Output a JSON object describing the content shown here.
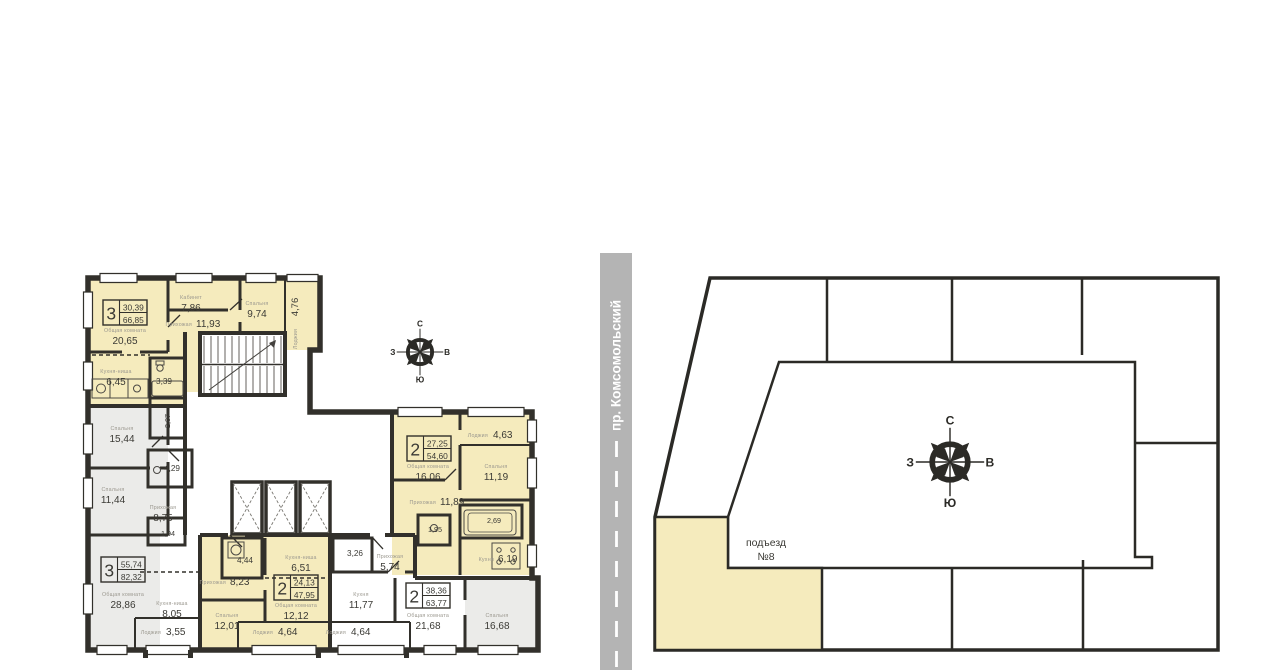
{
  "street": {
    "name": "пр. Комсомольский"
  },
  "site": {
    "entrance_line1": "подъезд",
    "entrance_line2": "№8"
  },
  "compass": {
    "n": "С",
    "s": "Ю",
    "w": "З",
    "e": "В"
  },
  "colors": {
    "highlight": "#f5ebbd",
    "wall": "#32302b",
    "room_gray": "#ebebe9",
    "road": "#b4b4b4"
  },
  "badges": {
    "a3_top": {
      "num": "3",
      "living": "30,39",
      "total": "66,85"
    },
    "a3_left": {
      "num": "3",
      "living": "55,74",
      "total": "82,32"
    },
    "a2_mid": {
      "num": "2",
      "living": "24,13",
      "total": "47,95"
    },
    "a2_bottom": {
      "num": "2",
      "living": "38,36",
      "total": "63,77"
    },
    "a2_right": {
      "num": "2",
      "living": "27,25",
      "total": "54,60"
    }
  },
  "rooms": {
    "r_obsh_top": {
      "name": "Общая комната",
      "area": "20,65"
    },
    "r_kabinet": {
      "name": "Кабинет",
      "area": "7,86"
    },
    "r_prihoz_top": {
      "name": "Прихожая",
      "area": "11,93"
    },
    "r_spalnya_974": {
      "name": "Спальня",
      "area": "9,74"
    },
    "r_lodzhiya_476": {
      "name": "Лоджия",
      "area": "4,76"
    },
    "r_kuhnya_645": {
      "name": "Кухня-ниша",
      "area": "6,45"
    },
    "r_san_339": {
      "area": "3,39"
    },
    "r_san_207": {
      "area": "2,07"
    },
    "r_spalnya_1544": {
      "name": "Спальня",
      "area": "15,44"
    },
    "r_spalnya_1144": {
      "name": "Спальня",
      "area": "11,44"
    },
    "r_san_429": {
      "area": "4,29"
    },
    "r_prihoz_875": {
      "name": "Прихожая",
      "area": "8,75"
    },
    "r_san_194": {
      "area": "1,94"
    },
    "r_obsh_2886": {
      "name": "Общая комната",
      "area": "28,86"
    },
    "r_kuhnya_805": {
      "name": "Кухня-ниша",
      "area": "8,05"
    },
    "r_lodzhiya_355": {
      "name": "Лоджия",
      "area": "3,55"
    },
    "r_san_444": {
      "area": "4,44"
    },
    "r_prihoz_823": {
      "name": "Прихожая",
      "area": "8,23"
    },
    "r_spalnya_1201": {
      "name": "Спальня",
      "area": "12,01"
    },
    "r_kuhnya_651": {
      "name": "Кухня-ниша",
      "area": "6,51"
    },
    "r_obsh_1212": {
      "name": "Общая комната",
      "area": "12,12"
    },
    "r_lodzhiya_464a": {
      "name": "Лоджия",
      "area": "4,64"
    },
    "r_san_326": {
      "area": "3,26"
    },
    "r_prihoz_574": {
      "name": "Прихожая",
      "area": "5,74"
    },
    "r_kuhnya_1177": {
      "name": "Кухня",
      "area": "11,77"
    },
    "r_lodzhiya_464b": {
      "name": "Лоджия",
      "area": "4,64"
    },
    "r_obsh_2168": {
      "name": "Общая комната",
      "area": "21,68"
    },
    "r_spalnya_1668": {
      "name": "Спальня",
      "area": "16,68"
    },
    "r_obsh_1606": {
      "name": "Общая комната",
      "area": "16,06"
    },
    "r_lodzhiya_463": {
      "name": "Лоджия",
      "area": "4,63"
    },
    "r_spalnya_1119": {
      "name": "Спальня",
      "area": "11,19"
    },
    "r_prihoz_1189": {
      "name": "Прихожая",
      "area": "11,89"
    },
    "r_san_195": {
      "area": "1,95"
    },
    "r_san_269": {
      "area": "2,69"
    },
    "r_kuhnya_619": {
      "name": "Кухня",
      "area": "6,19"
    }
  }
}
